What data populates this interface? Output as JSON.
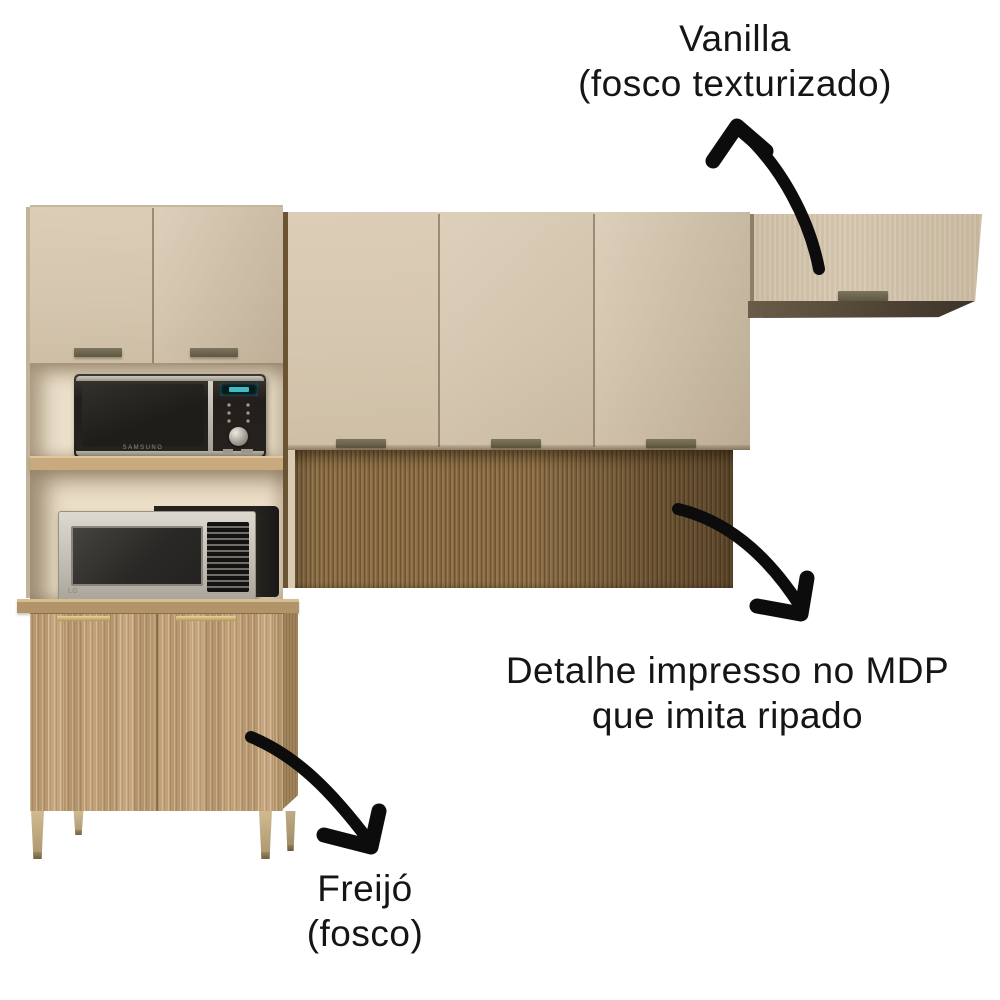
{
  "annotations": {
    "vanilla": {
      "line1": "Vanilla",
      "line2": "(fosco texturizado)"
    },
    "mdp_detail": {
      "line1": "Detalhe impresso no MDP",
      "line2": "que imita ripado"
    },
    "freijo": {
      "line1": "Freijó",
      "line2": "(fosco)"
    }
  },
  "appliances": {
    "top_microwave_brand": "SAMSUNG",
    "bottom_microwave_brand": "LG"
  },
  "colors": {
    "vanilla_finish": "#d6c7b0",
    "freijo_finish": "#c2a379",
    "ripado_panel": "#8a6d46",
    "annotation_text": "#151515",
    "arrow": "#0c0c0c",
    "handle_dark": "#6e6753",
    "handle_gold": "#c9ad67",
    "microwave_display": "#4fd8e0",
    "background": "#ffffff"
  }
}
